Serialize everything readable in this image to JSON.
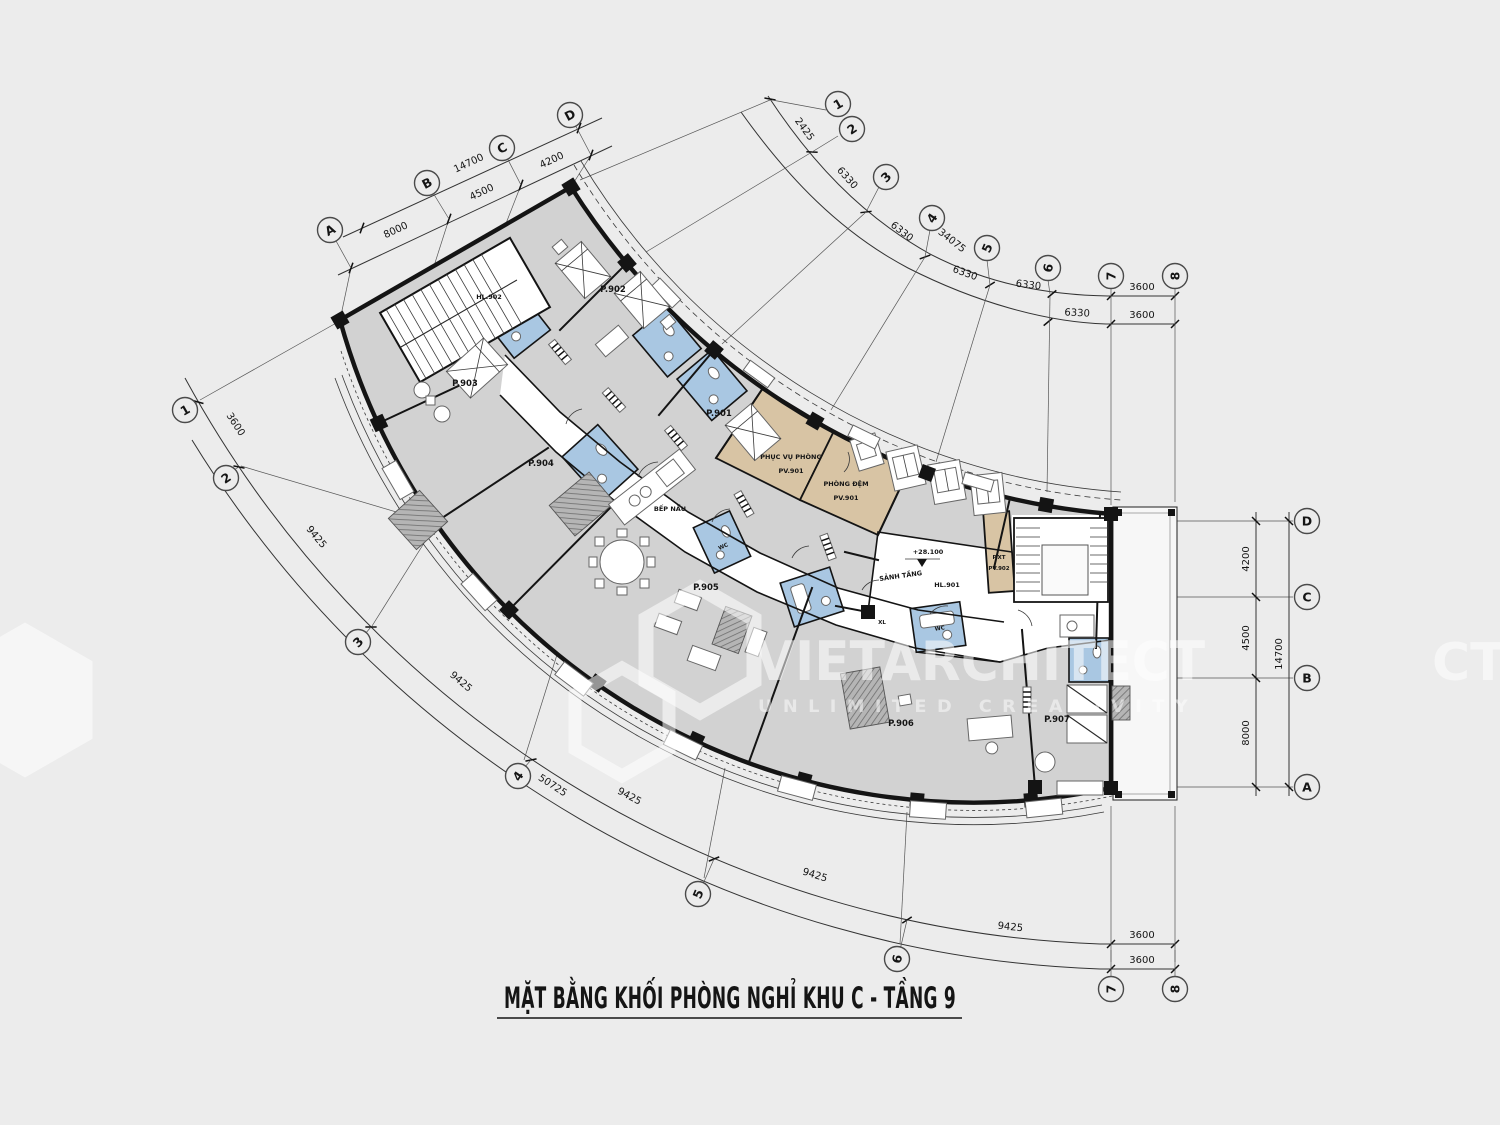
{
  "title": {
    "text": "MẶT BẰNG KHỐI PHÒNG NGHỈ KHU C - TẦNG 9"
  },
  "watermark": {
    "brand": "VIETARCHITECT",
    "tagline": "UNLIMITED CREATIVITY",
    "edge_fragment": "CT"
  },
  "colors": {
    "background": "#ececec",
    "room_gray": "#d2d2d2",
    "bath_blue": "#a9c7e2",
    "service_tan": "#d8c4a4",
    "wall": "#141414",
    "watermark": "#ffffff"
  },
  "grid": {
    "n1": "1",
    "n2": "2",
    "n3": "3",
    "n4": "4",
    "n5": "5",
    "n6": "6",
    "n7": "7",
    "n8": "8",
    "la": "A",
    "lb": "B",
    "lc": "C",
    "ld": "D"
  },
  "dims": {
    "d2425": "2425",
    "d6330": "6330",
    "d34075": "34075",
    "d3600": "3600",
    "d9425": "9425",
    "d50725": "50725",
    "d4200": "4200",
    "d4500": "4500",
    "d8000": "8000",
    "d14700": "14700"
  },
  "rooms": {
    "hl902": "HL.902",
    "p901": "P.901",
    "p902": "P.902",
    "p903": "P.903",
    "p904": "P.904",
    "p905": "P.905",
    "p906": "P.906",
    "p907": "P.907",
    "kitchen": "BẾP NẤU",
    "service": "PHỤC VỤ PHÒNG",
    "service_no": "PV.901",
    "buffer": "PHÒNG ĐỆM",
    "buffer_no": "PV.901",
    "lobby": "SẢNH TẦNG",
    "hall_no": "HL.901",
    "level": "+28.100",
    "pxt": "P.XT",
    "pxt_no": "PV.902",
    "xl": "XL",
    "wc": "WC"
  }
}
